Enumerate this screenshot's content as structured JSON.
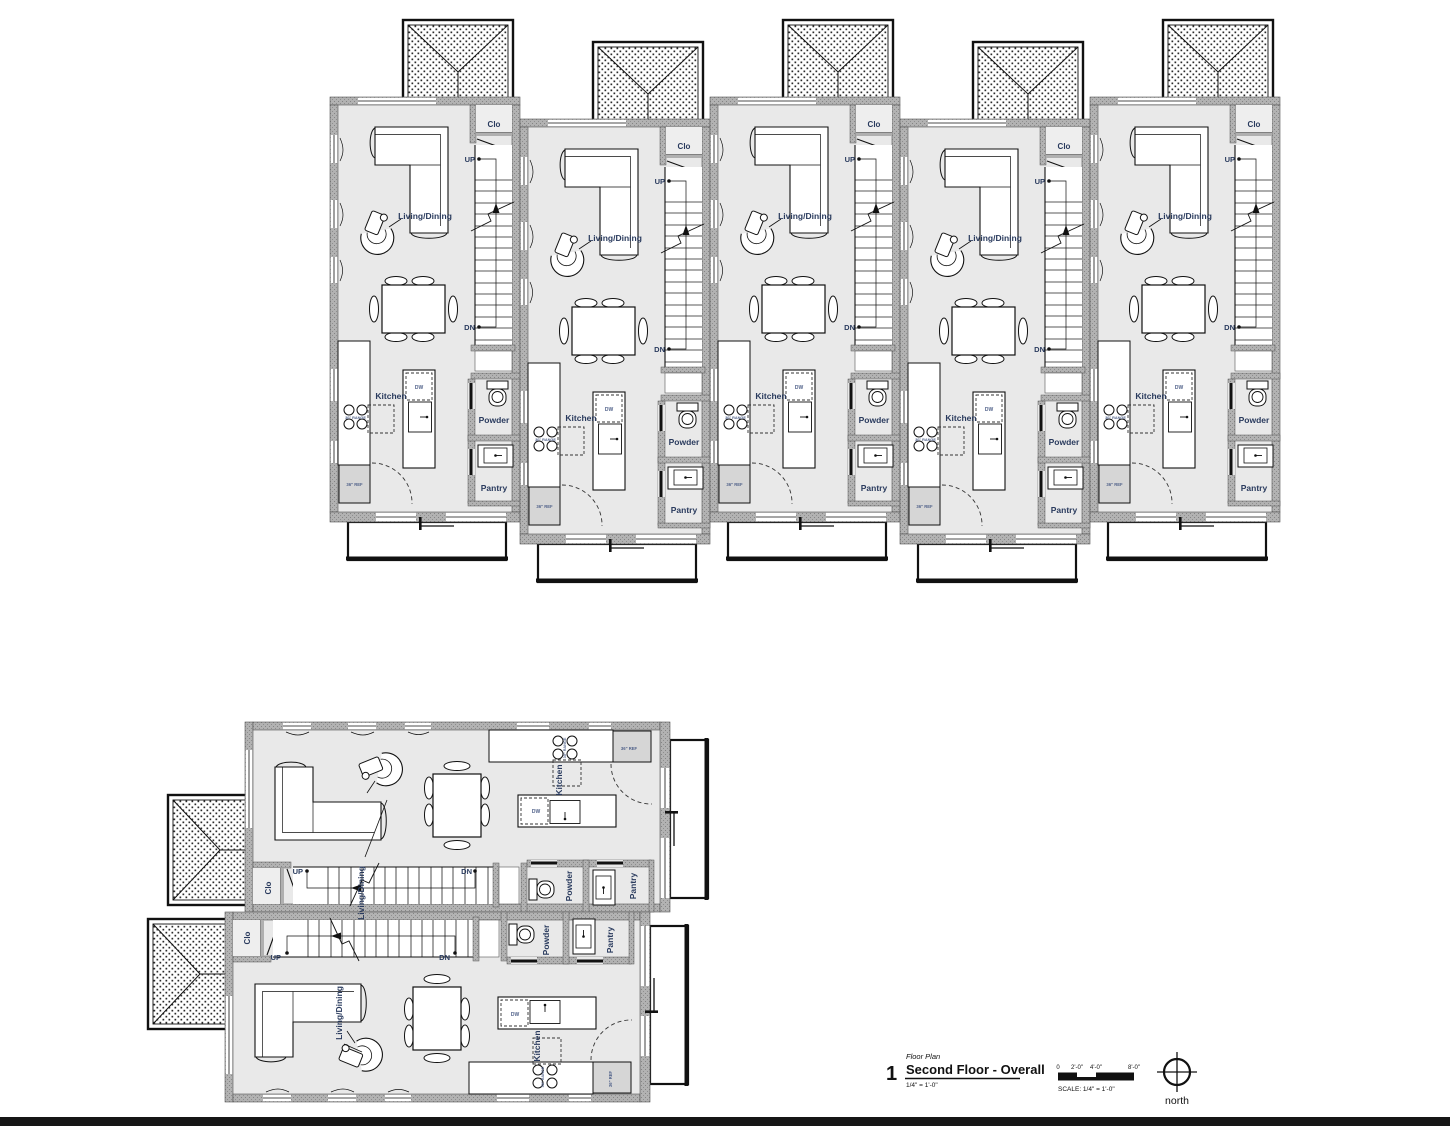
{
  "drawing": {
    "callout_number": "1",
    "category": "Floor Plan",
    "title": "Second Floor - Overall",
    "scale_note": "1/4\" = 1'-0\"",
    "scale_caption": "SCALE: 1/4\" = 1'-0\"",
    "scale_ticks": [
      "0",
      "2'-0\"",
      "4'-0\"",
      "8'-0\""
    ],
    "north_label": "north"
  },
  "unit_labels": {
    "living_dining": "Living/Dining",
    "kitchen": "Kitchen",
    "powder": "Powder",
    "pantry": "Pantry",
    "closet": "Clo",
    "up": "UP",
    "down": "DN",
    "dishwasher": "DW",
    "range": "30\" RANGE",
    "refrigerator": "36\" REF"
  },
  "colors": {
    "floor": "#e9e9e9",
    "wall_gray": "#b0b0b0",
    "line": "#1a1a1a",
    "label_navy": "#2a3b5e"
  }
}
